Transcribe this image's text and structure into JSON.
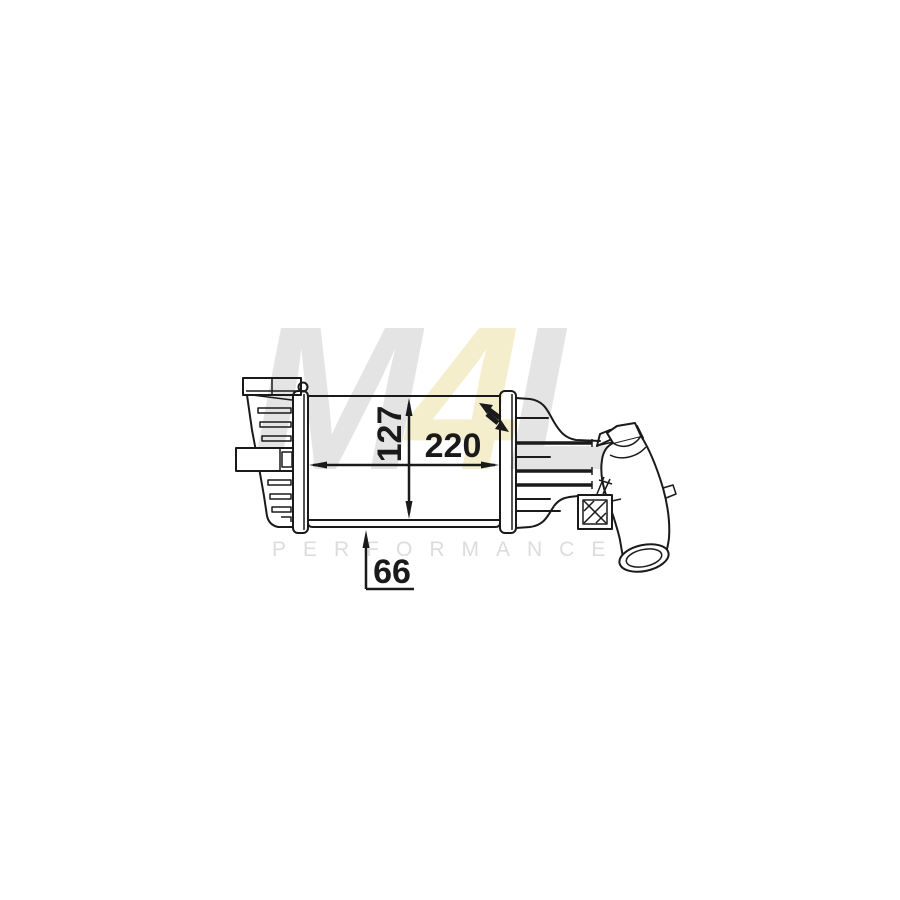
{
  "page": {
    "background_color": "#ffffff"
  },
  "drawing": {
    "line_color": "#1a1a1a",
    "dimensions": {
      "core_height": "127",
      "core_width": "220",
      "core_depth": "66"
    }
  },
  "watermark": {
    "letters": [
      {
        "char": "M",
        "color": "#e4e4e4"
      },
      {
        "char": "4",
        "color": "#f5eecd"
      },
      {
        "char": "L",
        "color": "#e4e4e4"
      }
    ],
    "subtitle": "PERFORMANCE",
    "subtitle_color": "#dcdcdc"
  }
}
